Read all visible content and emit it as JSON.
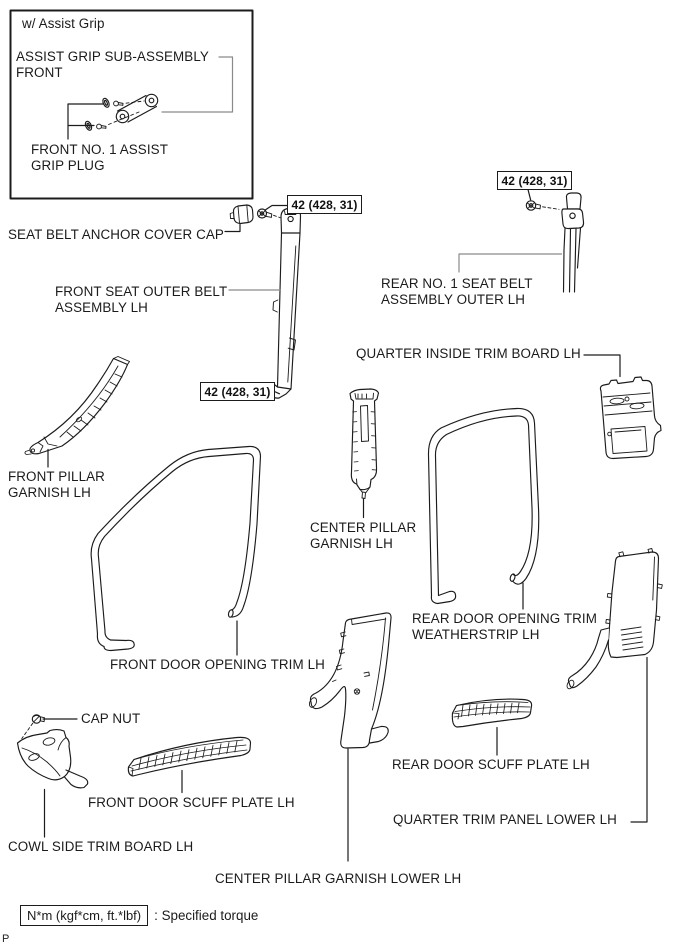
{
  "variant_box": {
    "title": "w/ Assist Grip"
  },
  "labels": {
    "assist_grip_sub_assembly": "ASSIST GRIP SUB-ASSEMBLY\nFRONT",
    "front_no1_assist_grip_plug": "FRONT NO. 1 ASSIST\nGRIP PLUG",
    "seat_belt_anchor_cover_cap": "SEAT BELT ANCHOR COVER CAP",
    "front_seat_outer_belt": "FRONT SEAT OUTER BELT\nASSEMBLY LH",
    "rear_no1_seat_belt": "REAR NO. 1 SEAT BELT\nASSEMBLY OUTER LH",
    "quarter_inside_trim_board": "QUARTER INSIDE TRIM BOARD LH",
    "front_pillar_garnish": "FRONT PILLAR\nGARNISH LH",
    "center_pillar_garnish": "CENTER PILLAR\nGARNISH LH",
    "rear_door_opening_trim_weatherstrip": "REAR DOOR OPENING TRIM\nWEATHERSTRIP LH",
    "front_door_opening_trim": "FRONT DOOR OPENING TRIM LH",
    "cap_nut": "CAP NUT",
    "front_door_scuff_plate": "FRONT DOOR SCUFF PLATE LH",
    "cowl_side_trim_board": "COWL SIDE TRIM BOARD LH",
    "rear_door_scuff_plate": "REAR DOOR SCUFF PLATE LH",
    "quarter_trim_panel_lower": "QUARTER TRIM PANEL LOWER LH",
    "center_pillar_garnish_lower": "CENTER PILLAR GARNISH LOWER LH"
  },
  "torque_callouts": [
    {
      "value": "42 (428, 31)"
    },
    {
      "value": "42 (428, 31)"
    },
    {
      "value": "42 (428, 31)"
    }
  ],
  "legend": {
    "unit_box": "N*m (kgf*cm, ft.*lbf)",
    "text": ": Specified torque"
  },
  "page_marker": "P",
  "colors": {
    "line": "#1c1c1c",
    "leader_gray": "#8a8a8a",
    "background": "#ffffff"
  }
}
